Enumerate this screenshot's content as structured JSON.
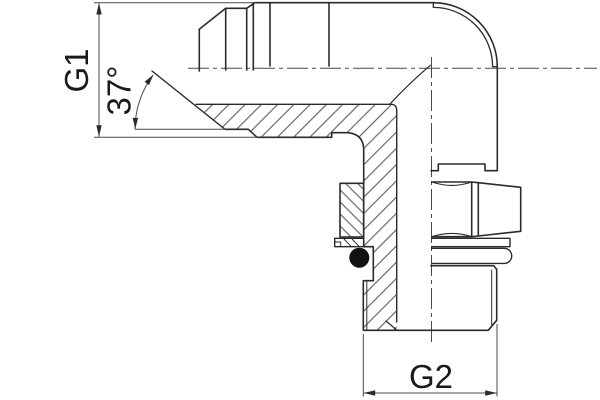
{
  "drawing": {
    "kind": "technical-drawing",
    "subject": "90-degree elbow fitting, half-section view",
    "labels": {
      "g1": "G1",
      "angle": "37°",
      "g2": "G2"
    },
    "colors": {
      "line": "#2b2b2b",
      "thin_line": "#4a4a4a",
      "hatch": "#4a4a4a",
      "text": "#1a1a1a",
      "background": "#ffffff",
      "seal_fill": "#111111"
    }
  }
}
